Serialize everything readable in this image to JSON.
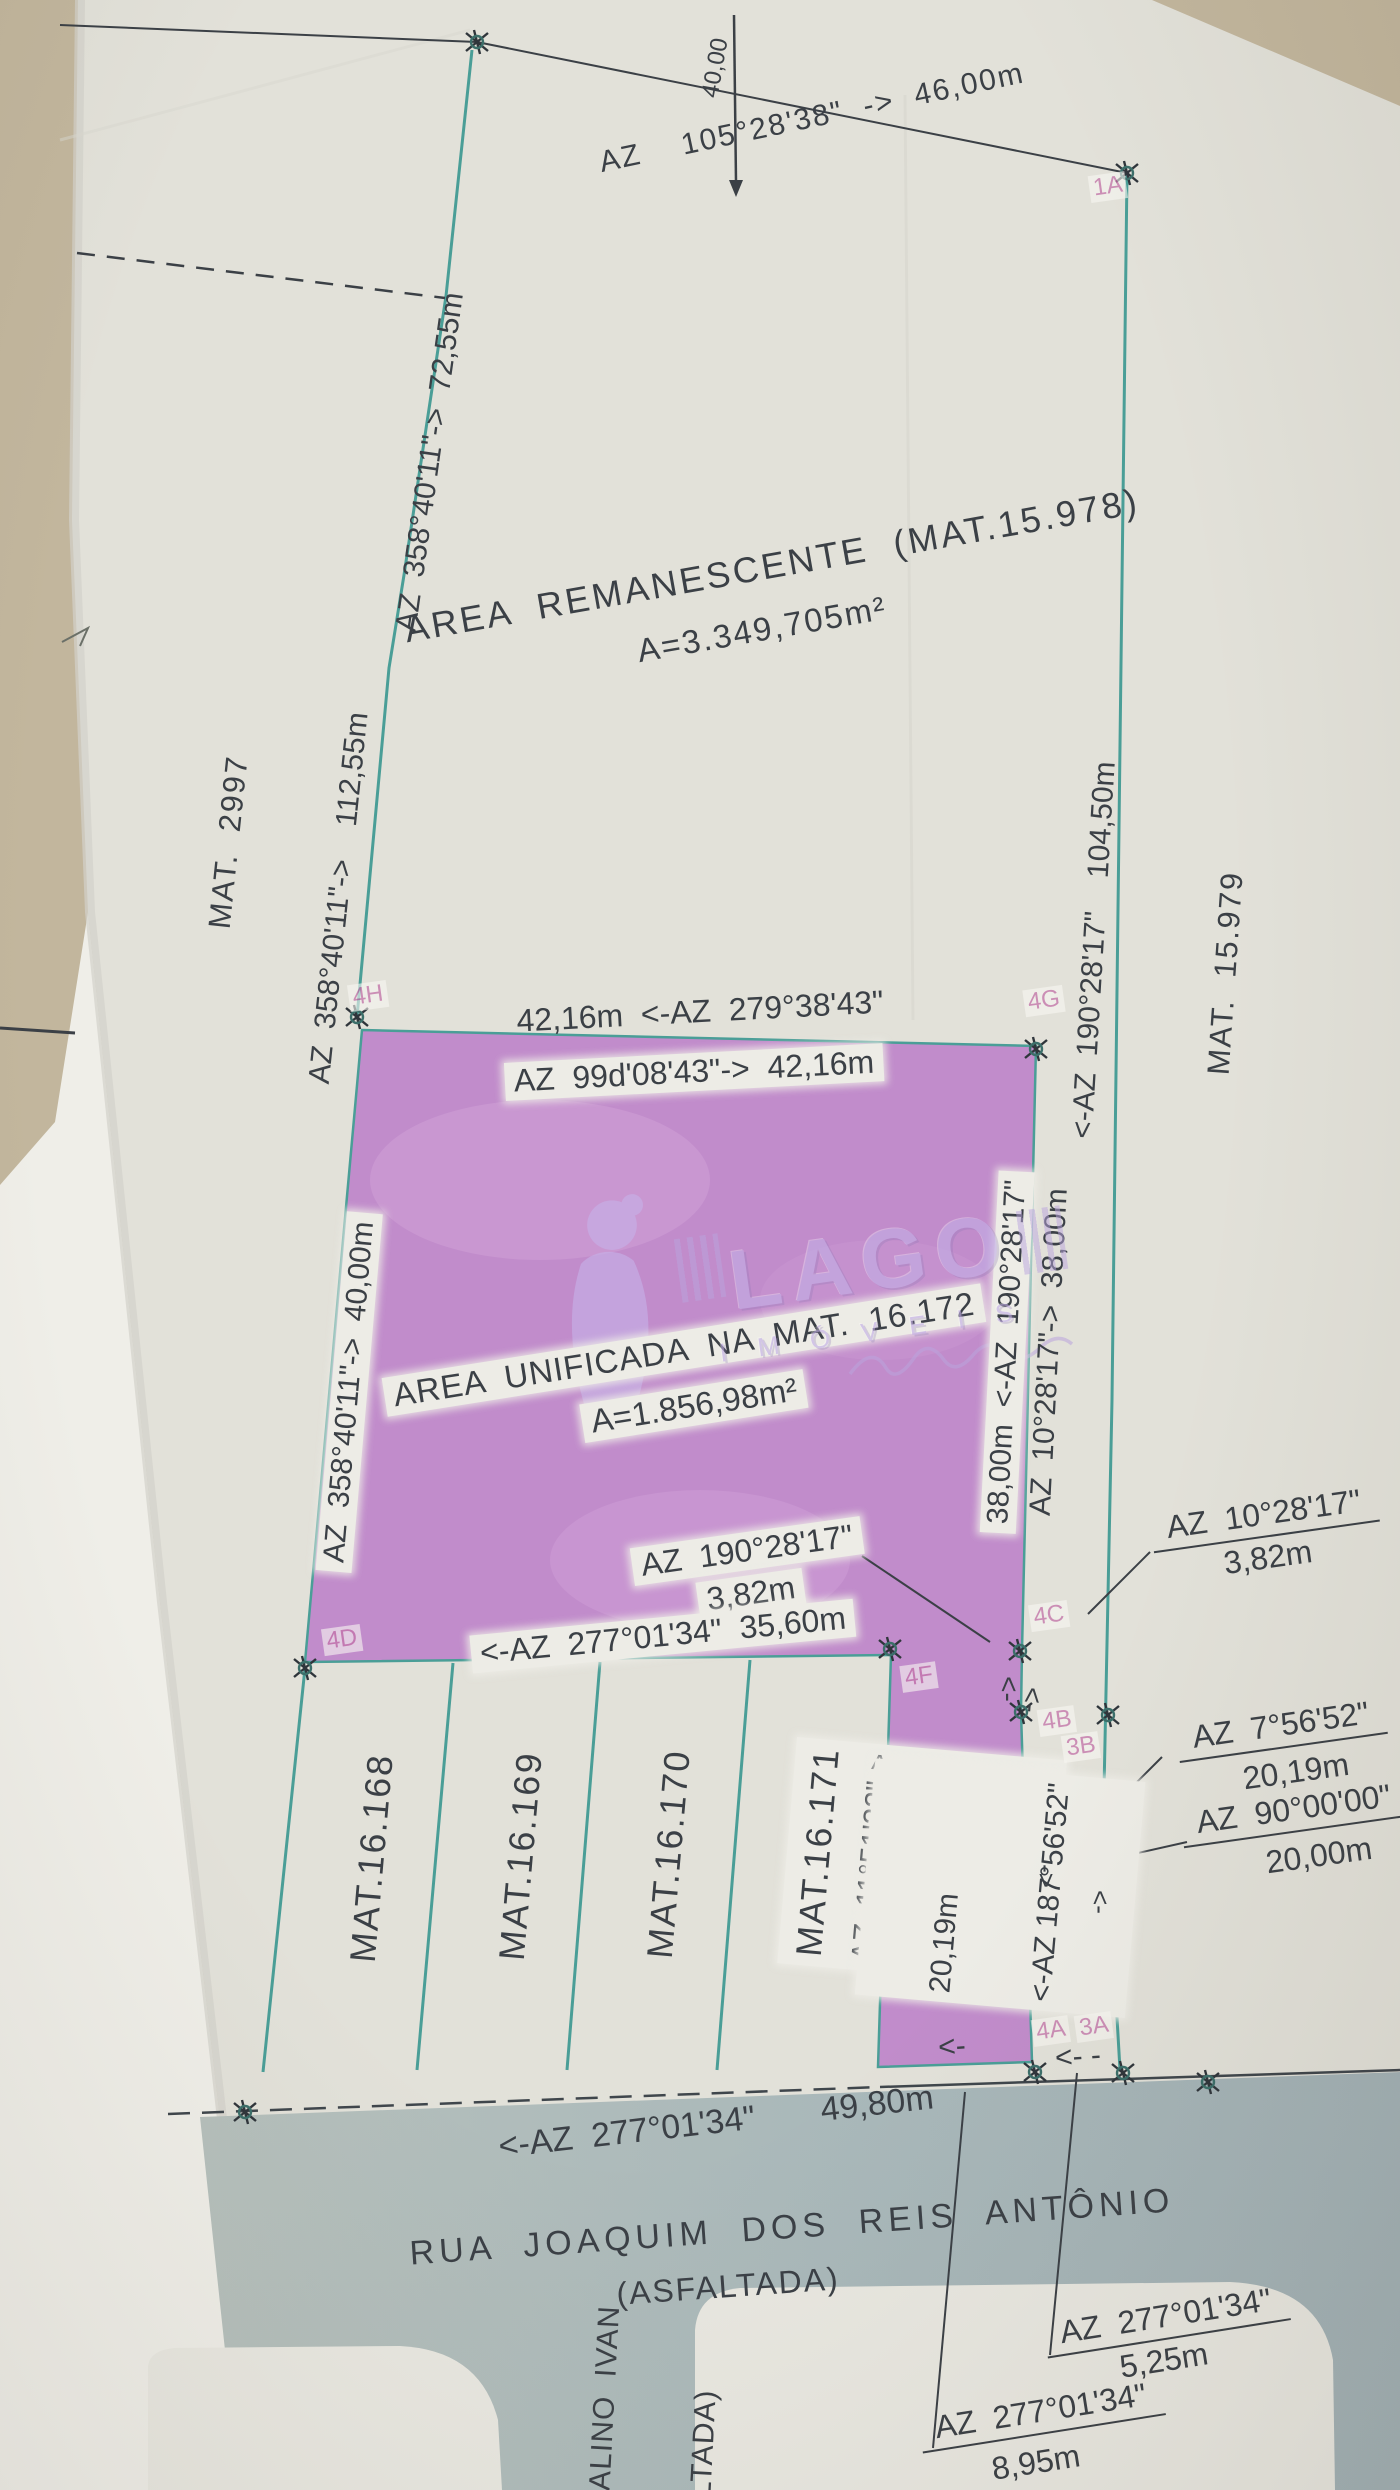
{
  "colors": {
    "background": "#c2b69d",
    "paper": "#e2e1d9",
    "under_sheet": "#efeee8",
    "purple_area": "#c18ccb",
    "teal_line": "#4a9e97",
    "ink": "#3b4046",
    "road": "#adbabb",
    "point_label_pink": "#c473aa"
  },
  "parcels": {
    "remanescente_title": "AREA  REMANESCENTE  (MAT.15.978)",
    "remanescente_area": "A=3.349,705m²",
    "unificada_title": "AREA  UNIFICADA  NA  MAT.  16.172",
    "unificada_area": "A=1.856,98m²",
    "mat_2997": "MAT.  2997",
    "mat_15979": "MAT.  15.979",
    "lots": [
      "MAT.16.168",
      "MAT.16.169",
      "MAT.16.170",
      "MAT.16.171"
    ]
  },
  "bearings": {
    "top": "AZ    105°28'38\"  ->  46,00m",
    "offset_40": "40,00",
    "west_upper": "AZ  358°40'11\"->  72,55m",
    "west_mid": "AZ  358°40'11\"->    112,55m",
    "west_lower": "AZ  358°40'11\"->  40,00m",
    "north_out": "42,16m  <-AZ  279°38'43\"",
    "north_in": "AZ  99d'08'43\"->  42,16m",
    "east_long": "<-AZ  190°28'17\"    104,50m",
    "east_in": "38,00m  <-AZ  190°28'17\"",
    "east_out": "AZ  10°28'17\"->  38,00m",
    "seg382_w_line1": "AZ  190°28'17\"",
    "seg382_w_line2": "3,82m",
    "seg382_e_line1": "AZ  10°28'17\"",
    "seg382_e_line2": "3,82m",
    "south_main": "<-AZ  277°01'34\"  35,60m",
    "strip_west_line1": "AZ  11°51'32\"->",
    "strip_west_line2": "24,00m",
    "strip_east_line1": "20,19m",
    "strip_east_line2": "<-AZ 187°56'52\"",
    "east_2019_line1": "AZ  7°56'52\"",
    "east_2019_line2": "20,19m",
    "east_2000_line1": "AZ  90°00'00\"",
    "east_2000_line2": "20,00m",
    "road_front": "<-AZ  277°01'34\"       49,80m",
    "south_525_line1": "AZ  277°01'34\"",
    "south_525_line2": "5,25m",
    "south_895_line1": "AZ  277°01'34\"",
    "south_895_line2": "8,95m"
  },
  "points": {
    "p1a": "1A",
    "p4h": "4H",
    "p4g": "4G",
    "p4d": "4D",
    "p4c": "4C",
    "p4f": "4F",
    "p4b": "4B",
    "p3b": "3B",
    "p4a": "4A",
    "p3a": "3A"
  },
  "streets": {
    "main_name": "RUA  JOAQUIM  DOS  REIS  ANTÔNIO",
    "main_type": "(ASFALTADA)",
    "cross_line1": "DALINO  IVAN",
    "cross_line2": "ALTADA)"
  },
  "watermark": {
    "brand": "LAGO",
    "sub": "I M Ó V E I S"
  },
  "glyphs": {
    "arrow_left": "<-",
    "arrow_left_dash": "<- -",
    "arrow_right": "->"
  }
}
